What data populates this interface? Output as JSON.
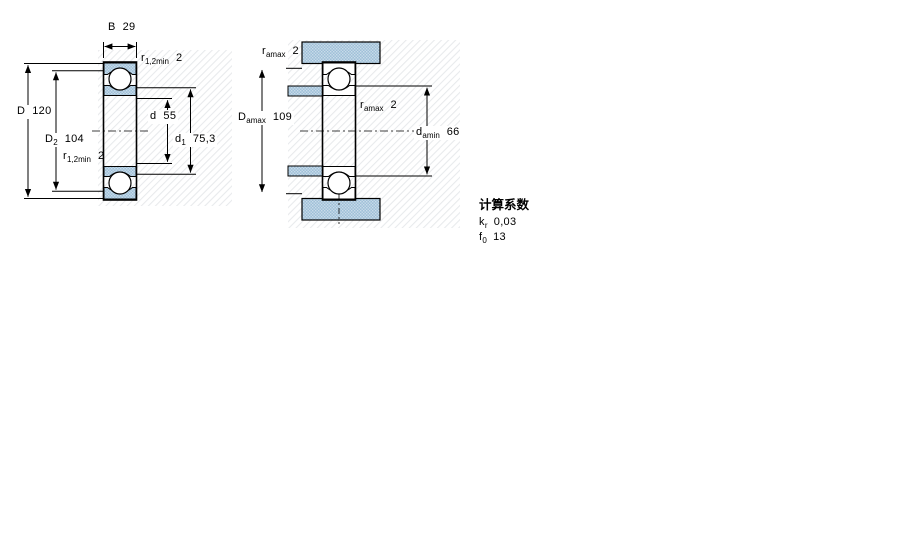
{
  "figure1": {
    "title": "bearing cross-section view",
    "dims": {
      "b": {
        "base": "B",
        "sub": "",
        "value": "29"
      },
      "r12_top": {
        "base": "r",
        "sub": "1,2min",
        "value": "2"
      },
      "D": {
        "base": "D",
        "sub": "",
        "value": "120"
      },
      "D2": {
        "base": "D",
        "sub": "2",
        "value": "104"
      },
      "r12_bot": {
        "base": "r",
        "sub": "1,2min",
        "value": "2"
      },
      "d": {
        "base": "d",
        "sub": "",
        "value": "55"
      },
      "d1": {
        "base": "d",
        "sub": "1",
        "value": "75,3"
      }
    }
  },
  "figure2": {
    "title": "bearing mounting / abutment view",
    "dims": {
      "ra_top": {
        "base": "r",
        "sub": "amax",
        "value": "2"
      },
      "Damax": {
        "base": "D",
        "sub": "amax",
        "value": "109"
      },
      "ra_mid": {
        "base": "r",
        "sub": "amax",
        "value": "2"
      },
      "damin": {
        "base": "d",
        "sub": "amin",
        "value": "66"
      }
    }
  },
  "factors": {
    "heading": "计算系数",
    "rows": [
      {
        "base": "k",
        "sub": "r",
        "value": "0,03"
      },
      {
        "base": "f",
        "sub": "0",
        "value": "13"
      }
    ]
  },
  "colors": {
    "section_fill": "#9fc0d8",
    "section_dot": "#cadcea",
    "outline": "#000000",
    "hatch": "#e8eaec"
  }
}
